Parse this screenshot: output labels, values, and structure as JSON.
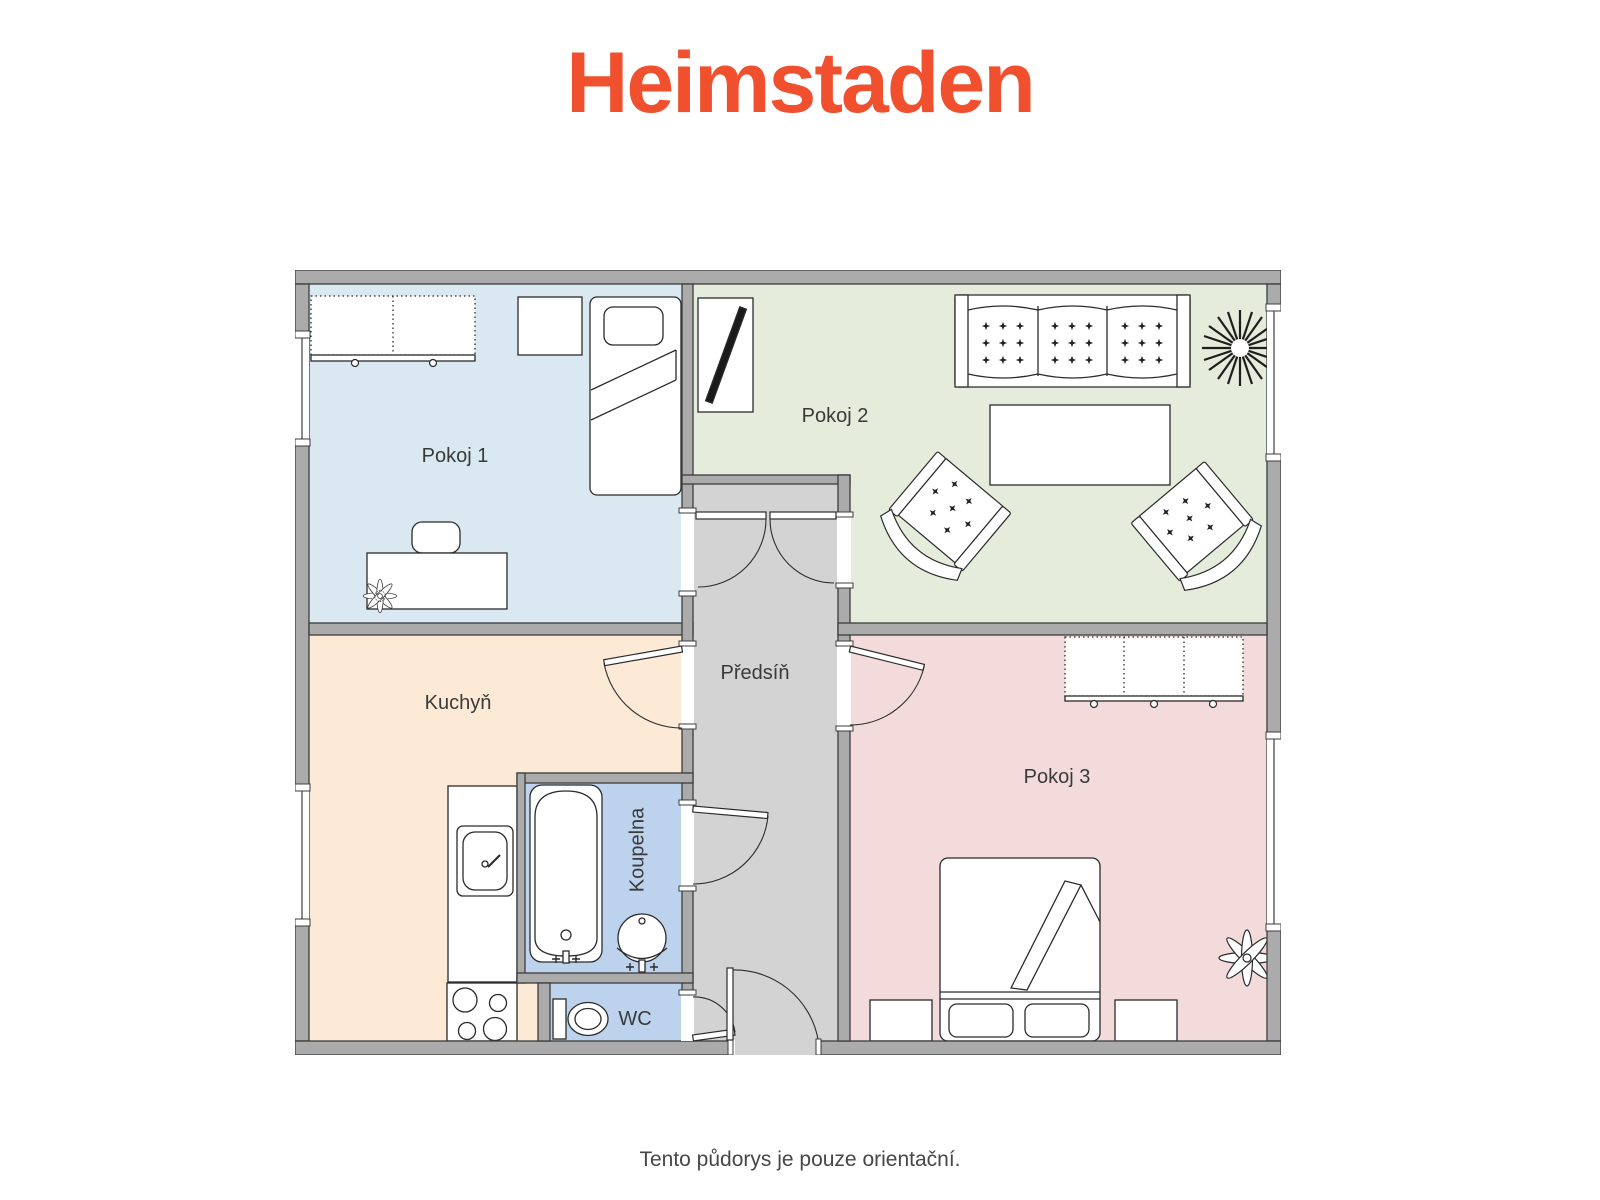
{
  "logo": {
    "text": "Heimstaden",
    "color": "#f0502e"
  },
  "caption": "Tento půdorys je pouze orientační.",
  "rooms": {
    "pokoj1": {
      "label": "Pokoj 1",
      "floor_color": "#d9e8f1"
    },
    "pokoj2": {
      "label": "Pokoj 2",
      "floor_color": "#e5ecdb"
    },
    "pokoj3": {
      "label": "Pokoj 3",
      "floor_color": "#f3dbdc"
    },
    "kuchyn": {
      "label": "Kuchyň",
      "floor_color": "#fcead7"
    },
    "predsin": {
      "label": "Předsíň",
      "floor_color": "#d3d3d3"
    },
    "koupelna": {
      "label": "Koupelna",
      "floor_color": "#bdd3ed"
    },
    "wc": {
      "label": "WC",
      "floor_color": "#bdd3ed"
    }
  },
  "plan": {
    "wall_color": "#ababab",
    "outline_color": "#3c3c3c",
    "label_color": "#3a3a3a"
  }
}
